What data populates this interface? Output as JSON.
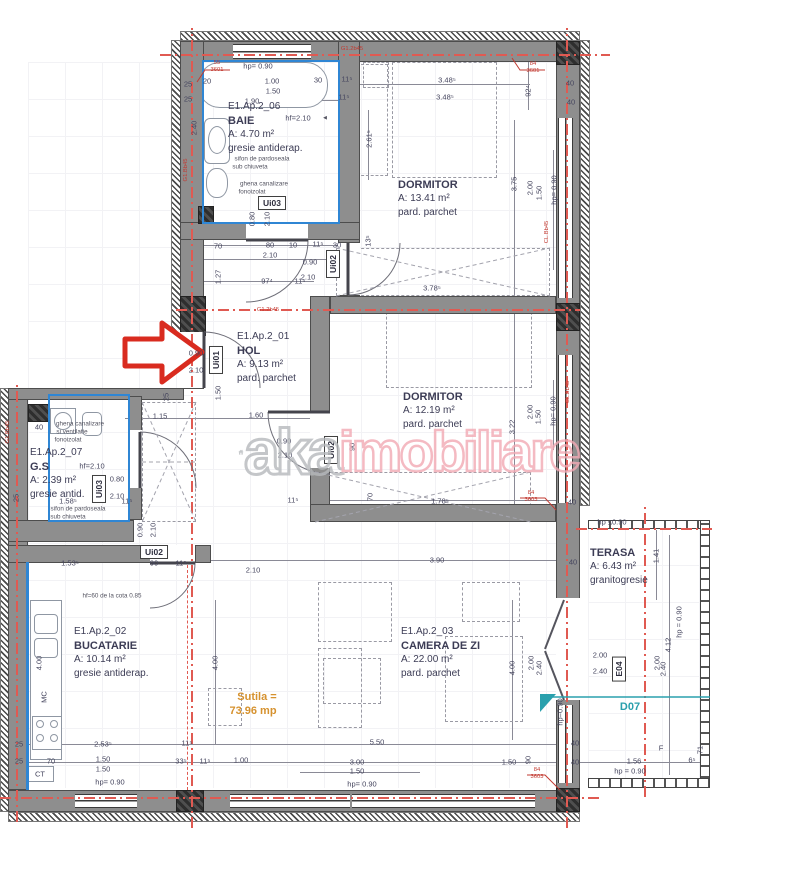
{
  "watermark": {
    "part1": "aka",
    "part2": "imobiliare"
  },
  "colors": {
    "wall_gray": "#8e8e8e",
    "axis_red": "#e05a52",
    "arrow_red": "#d92b1f",
    "teal": "#2aa0ad",
    "orange": "#d6922f",
    "watermark_pink": "#f2a9b4",
    "waterproof_blue": "#2f86d4",
    "text": "#3c3c55"
  },
  "rooms": {
    "baie": {
      "code": "E1.Ap.2_06",
      "name": "BAIE",
      "area": "A: 4.70 m²",
      "floor": "gresie antiderap."
    },
    "dormitor1": {
      "name": "DORMITOR",
      "area": "A: 13.41 m²",
      "floor": "pard. parchet"
    },
    "hol": {
      "code": "E1.Ap.2_01",
      "name": "HOL",
      "area": "A: 9.13 m²",
      "floor": "pard. parchet"
    },
    "dormitor2": {
      "name": "DORMITOR",
      "area": "A: 12.19 m²",
      "floor": "pard. parchet"
    },
    "gs": {
      "code": "E1.Ap.2_07",
      "name": "G.S",
      "area": "A: 2.39 m²",
      "floor": "gresie antid."
    },
    "bucatarie": {
      "code": "E1.Ap.2_02",
      "name": "BUCATARIE",
      "area": "A: 10.14 m²",
      "floor": "gresie antiderap."
    },
    "camera_de_zi": {
      "code": "E1.Ap.2_03",
      "name": "CAMERA DE ZI",
      "area": "A: 22.00 m²",
      "floor": "pard. parchet"
    },
    "terasa": {
      "name": "TERASA",
      "area": "A: 6.43 m²",
      "floor": "granitogresie"
    }
  },
  "door_tags": [
    {
      "t": "Ui03",
      "x": 272,
      "y": 203,
      "r": 0
    },
    {
      "t": "Ui02",
      "x": 333,
      "y": 264,
      "r": -90
    },
    {
      "t": "Ui01",
      "x": 216,
      "y": 360,
      "r": -90
    },
    {
      "t": "Ui02",
      "x": 331,
      "y": 450,
      "r": -90
    },
    {
      "t": "Ui03",
      "x": 99,
      "y": 489,
      "r": -90
    },
    {
      "t": "Ui02",
      "x": 154,
      "y": 552,
      "r": 0
    },
    {
      "t": "E04",
      "x": 619,
      "y": 669,
      "r": -90
    }
  ],
  "labels": [
    {
      "t": "hp= 0.90",
      "x": 258,
      "y": 66
    },
    {
      "t": "20",
      "x": 207,
      "y": 81
    },
    {
      "t": "1.00",
      "x": 272,
      "y": 81
    },
    {
      "t": "30",
      "x": 318,
      "y": 80
    },
    {
      "t": "11⁵",
      "x": 347,
      "y": 79
    },
    {
      "t": "1.50",
      "x": 273,
      "y": 91
    },
    {
      "t": "1.90",
      "x": 252,
      "y": 101
    },
    {
      "t": "11⁵",
      "x": 344,
      "y": 97
    },
    {
      "t": "25",
      "x": 188,
      "y": 84
    },
    {
      "t": "25",
      "x": 188,
      "y": 99
    },
    {
      "t": "55",
      "x": 217,
      "y": 63,
      "k": "r"
    },
    {
      "t": "3601",
      "x": 217,
      "y": 70,
      "k": "r"
    },
    {
      "t": "G1.2b45",
      "x": 352,
      "y": 49,
      "k": "r"
    },
    {
      "t": "84",
      "x": 533,
      "y": 64,
      "k": "r"
    },
    {
      "t": "3601",
      "x": 533,
      "y": 71,
      "k": "r"
    },
    {
      "t": "hf=2.10",
      "x": 298,
      "y": 118
    },
    {
      "t": "◄",
      "x": 325,
      "y": 118,
      "k": "a"
    },
    {
      "t": "sifon de pardoseala",
      "x": 262,
      "y": 159,
      "k": "a"
    },
    {
      "t": "sub chiuveta",
      "x": 250,
      "y": 167,
      "k": "a"
    },
    {
      "t": "ghena canalizare",
      "x": 264,
      "y": 184,
      "k": "a"
    },
    {
      "t": "fonoizolat",
      "x": 252,
      "y": 192,
      "k": "a"
    },
    {
      "t": "0.80",
      "x": 252,
      "y": 219,
      "r": -90
    },
    {
      "t": "2.10",
      "x": 267,
      "y": 219,
      "r": -90
    },
    {
      "t": "2.40",
      "x": 194,
      "y": 128,
      "r": -90
    },
    {
      "t": "70",
      "x": 218,
      "y": 246
    },
    {
      "t": "80",
      "x": 270,
      "y": 245
    },
    {
      "t": "10",
      "x": 293,
      "y": 245
    },
    {
      "t": "11⁵",
      "x": 318,
      "y": 244
    },
    {
      "t": "30",
      "x": 337,
      "y": 245
    },
    {
      "t": "2.10",
      "x": 270,
      "y": 255
    },
    {
      "t": "0.90",
      "x": 310,
      "y": 262
    },
    {
      "t": "2.10",
      "x": 308,
      "y": 277
    },
    {
      "t": "97⁴",
      "x": 267,
      "y": 281
    },
    {
      "t": "11⁵",
      "x": 300,
      "y": 281
    },
    {
      "t": "1.27",
      "x": 218,
      "y": 277,
      "r": -90
    },
    {
      "t": "13⁵",
      "x": 368,
      "y": 241,
      "r": -90
    },
    {
      "t": "3.48⁵",
      "x": 447,
      "y": 80
    },
    {
      "t": "3.48⁵",
      "x": 445,
      "y": 97
    },
    {
      "t": "92⁴",
      "x": 528,
      "y": 91,
      "r": -90
    },
    {
      "t": "2.61⁵",
      "x": 369,
      "y": 139,
      "r": -90
    },
    {
      "t": "3.75",
      "x": 514,
      "y": 184,
      "r": -90
    },
    {
      "t": "2.00",
      "x": 530,
      "y": 188,
      "r": -90
    },
    {
      "t": "1.50",
      "x": 539,
      "y": 193,
      "r": -90
    },
    {
      "t": "hp= 0.90",
      "x": 554,
      "y": 190,
      "r": -90
    },
    {
      "t": "40",
      "x": 570,
      "y": 83
    },
    {
      "t": "40",
      "x": 571,
      "y": 102
    },
    {
      "t": "G1.2b45",
      "x": 268,
      "y": 310,
      "k": "r"
    },
    {
      "t": "0.90",
      "x": 196,
      "y": 353
    },
    {
      "t": "2.10",
      "x": 196,
      "y": 370
    },
    {
      "t": "1.50",
      "x": 218,
      "y": 393,
      "r": -90
    },
    {
      "t": "25",
      "x": 166,
      "y": 397,
      "r": -90
    },
    {
      "t": "1.15",
      "x": 160,
      "y": 416
    },
    {
      "t": "1.60",
      "x": 256,
      "y": 415
    },
    {
      "t": "3.78⁵",
      "x": 432,
      "y": 288
    },
    {
      "t": "0.90",
      "x": 284,
      "y": 441
    },
    {
      "t": "2.10",
      "x": 285,
      "y": 455
    },
    {
      "t": "90",
      "x": 352,
      "y": 447,
      "r": -90
    },
    {
      "t": "70",
      "x": 370,
      "y": 497,
      "r": -90
    },
    {
      "t": "11⁵",
      "x": 293,
      "y": 500
    },
    {
      "t": "3.22",
      "x": 512,
      "y": 427,
      "r": -90
    },
    {
      "t": "2.00",
      "x": 530,
      "y": 412,
      "r": -90
    },
    {
      "t": "1.50",
      "x": 538,
      "y": 417,
      "r": -90
    },
    {
      "t": "hp= 0.90",
      "x": 553,
      "y": 411,
      "r": -90
    },
    {
      "t": "1.78⁵",
      "x": 440,
      "y": 501
    },
    {
      "t": "40",
      "x": 572,
      "y": 502
    },
    {
      "t": "84",
      "x": 531,
      "y": 493,
      "k": "r"
    },
    {
      "t": "3603",
      "x": 531,
      "y": 500,
      "k": "r"
    },
    {
      "t": "CL.Bb45",
      "x": 547,
      "y": 232,
      "r": -90,
      "k": "r"
    },
    {
      "t": "CL.Bb45",
      "x": 568,
      "y": 392,
      "r": -90,
      "k": "r"
    },
    {
      "t": "G1.Bb45",
      "x": 186,
      "y": 170,
      "r": -90,
      "k": "r"
    },
    {
      "t": "G1.Bb45",
      "x": 8,
      "y": 432,
      "r": -90,
      "k": "r"
    },
    {
      "t": "ghena canalizare",
      "x": 80,
      "y": 424,
      "k": "a"
    },
    {
      "t": "si ventilatie",
      "x": 72,
      "y": 432,
      "k": "a"
    },
    {
      "t": "fonoizolat",
      "x": 68,
      "y": 440,
      "k": "a"
    },
    {
      "t": "40",
      "x": 39,
      "y": 427
    },
    {
      "t": "hf=2.10",
      "x": 92,
      "y": 466
    },
    {
      "t": "0.80",
      "x": 117,
      "y": 479
    },
    {
      "t": "2.10",
      "x": 117,
      "y": 496
    },
    {
      "t": "1.58⁵",
      "x": 68,
      "y": 501
    },
    {
      "t": "sifon de pardoseala",
      "x": 78,
      "y": 509,
      "k": "a"
    },
    {
      "t": "sub chiuveta",
      "x": 68,
      "y": 517,
      "k": "a"
    },
    {
      "t": "25",
      "x": 16,
      "y": 498,
      "r": -90
    },
    {
      "t": "11⁵",
      "x": 127,
      "y": 501
    },
    {
      "t": "0.90",
      "x": 140,
      "y": 530,
      "r": -90
    },
    {
      "t": "2.10",
      "x": 153,
      "y": 530,
      "r": -90
    },
    {
      "t": "1.53⁵",
      "x": 70,
      "y": 563
    },
    {
      "t": "90",
      "x": 154,
      "y": 563
    },
    {
      "t": "11⁵",
      "x": 181,
      "y": 563
    },
    {
      "t": "2.10",
      "x": 253,
      "y": 570
    },
    {
      "t": "3.90",
      "x": 437,
      "y": 560
    },
    {
      "t": "hf=60 de la cota 0.85",
      "x": 112,
      "y": 596,
      "k": "a"
    },
    {
      "t": "4.00",
      "x": 39,
      "y": 663,
      "r": -90
    },
    {
      "t": "MC",
      "x": 44,
      "y": 697,
      "r": -90
    },
    {
      "t": "4.00",
      "x": 215,
      "y": 663,
      "r": -90
    },
    {
      "t": "4.00",
      "x": 512,
      "y": 668,
      "r": -90
    },
    {
      "t": "2.53⁵",
      "x": 103,
      "y": 744
    },
    {
      "t": "11⁵",
      "x": 187,
      "y": 743
    },
    {
      "t": "70",
      "x": 51,
      "y": 761
    },
    {
      "t": "1.50",
      "x": 103,
      "y": 759
    },
    {
      "t": "1.50",
      "x": 103,
      "y": 769
    },
    {
      "t": "33⁵",
      "x": 181,
      "y": 761
    },
    {
      "t": "11⁵",
      "x": 205,
      "y": 761
    },
    {
      "t": "1.00",
      "x": 241,
      "y": 760
    },
    {
      "t": "CT",
      "x": 40,
      "y": 774
    },
    {
      "t": "hp= 0.90",
      "x": 110,
      "y": 782
    },
    {
      "t": "25",
      "x": 19,
      "y": 744
    },
    {
      "t": "25",
      "x": 19,
      "y": 761
    },
    {
      "t": "2.00",
      "x": 531,
      "y": 663,
      "r": -90
    },
    {
      "t": "2.40",
      "x": 539,
      "y": 668,
      "r": -90
    },
    {
      "t": "hp=0.90",
      "x": 560,
      "y": 712,
      "r": -90
    },
    {
      "t": "Sutila =",
      "x": 257,
      "y": 697,
      "k": "o"
    },
    {
      "t": "73.96 mp",
      "x": 253,
      "y": 711,
      "k": "o"
    },
    {
      "t": "5.50",
      "x": 377,
      "y": 742
    },
    {
      "t": "3.00",
      "x": 357,
      "y": 762
    },
    {
      "t": "1.50",
      "x": 357,
      "y": 771
    },
    {
      "t": "hp= 0.90",
      "x": 362,
      "y": 784
    },
    {
      "t": "1.50",
      "x": 509,
      "y": 762
    },
    {
      "t": "90",
      "x": 528,
      "y": 760,
      "r": -90
    },
    {
      "t": "40",
      "x": 575,
      "y": 743
    },
    {
      "t": "40",
      "x": 575,
      "y": 762
    },
    {
      "t": "84",
      "x": 537,
      "y": 770,
      "k": "r"
    },
    {
      "t": "3603",
      "x": 537,
      "y": 777,
      "k": "r"
    },
    {
      "t": "hp ≤0.90",
      "x": 612,
      "y": 522
    },
    {
      "t": "1.41",
      "x": 656,
      "y": 556,
      "r": -90
    },
    {
      "t": "hp = 0.90",
      "x": 679,
      "y": 622,
      "r": -90
    },
    {
      "t": "4.12",
      "x": 668,
      "y": 645,
      "r": -90
    },
    {
      "t": "2.00",
      "x": 657,
      "y": 663,
      "r": -90
    },
    {
      "t": "2.40",
      "x": 663,
      "y": 669,
      "r": -90
    },
    {
      "t": "2.00",
      "x": 600,
      "y": 655
    },
    {
      "t": "2.40",
      "x": 600,
      "y": 671
    },
    {
      "t": "D07",
      "x": 630,
      "y": 707,
      "k": "t"
    },
    {
      "t": "1.56",
      "x": 634,
      "y": 761
    },
    {
      "t": "hp = 0.90",
      "x": 630,
      "y": 771
    },
    {
      "t": "6⁵",
      "x": 692,
      "y": 760
    },
    {
      "t": "71",
      "x": 700,
      "y": 750,
      "r": -90
    },
    {
      "t": "F",
      "x": 661,
      "y": 748
    },
    {
      "t": "40",
      "x": 573,
      "y": 562
    }
  ]
}
